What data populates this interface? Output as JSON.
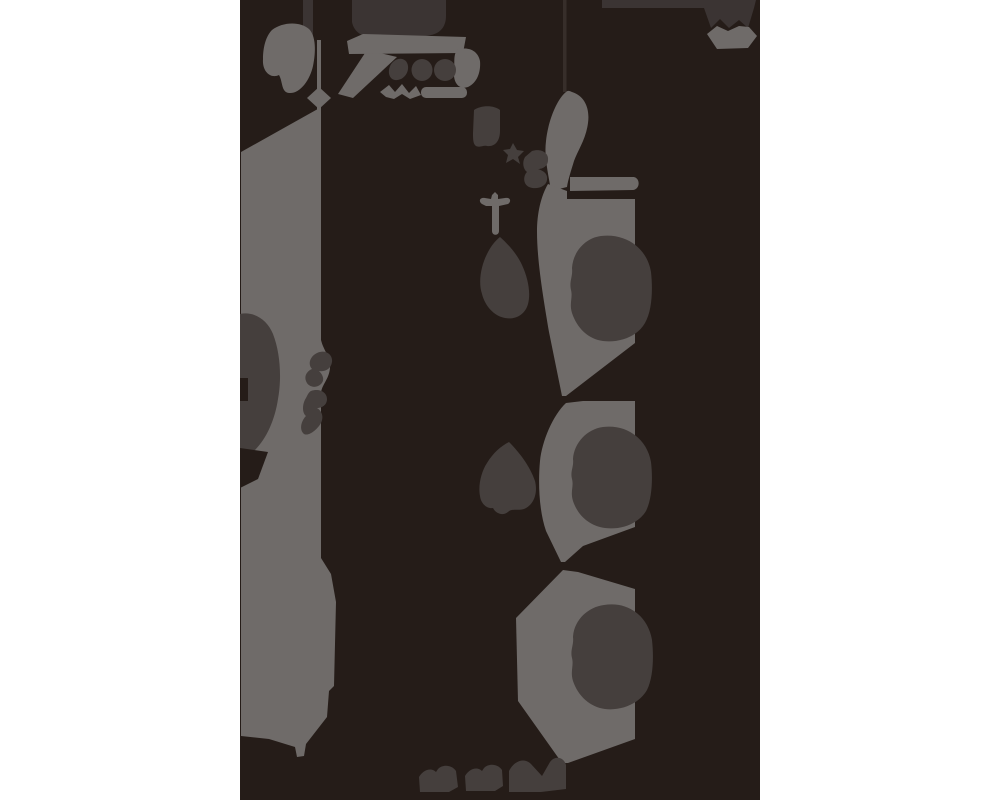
{
  "canvas": {
    "width": 1000,
    "height": 800,
    "background_color": "#ffffff"
  },
  "panel": {
    "x": 240,
    "y": 0,
    "width": 520,
    "height": 800,
    "tone": "panel_dark"
  },
  "palette": {
    "white": "#ffffff",
    "panel_dark": "#251c18",
    "light_gray": "#6f6b69",
    "mid_gray": "#453f3d",
    "dim_gray": "#3b3433",
    "faint_line": "#372e2a"
  },
  "figure": {
    "description_tones": [
      "panel_dark",
      "light_gray",
      "mid_gray",
      "dim_gray"
    ],
    "regions": [
      {
        "name": "top-left-kidney-blob",
        "tone": "light_gray"
      },
      {
        "name": "thin-vertical-line-with-diamond",
        "tone": "light_gray"
      },
      {
        "name": "checkmark-like-mark",
        "tone": "light_gray"
      },
      {
        "name": "top-light-band",
        "tone": "light_gray"
      },
      {
        "name": "three-round-glyphs",
        "tone": "mid_gray"
      },
      {
        "name": "small-wiggle-marks",
        "tone": "light_gray"
      },
      {
        "name": "right-small-blob",
        "tone": "light_gray"
      },
      {
        "name": "tall-left-column",
        "tone": "light_gray"
      },
      {
        "name": "left-edge-bulge",
        "tone": "mid_gray"
      },
      {
        "name": "column-curls",
        "tone": "mid_gray"
      },
      {
        "name": "square-blob",
        "tone": "mid_gray"
      },
      {
        "name": "four-point-star",
        "tone": "mid_gray"
      },
      {
        "name": "cluster-blob",
        "tone": "mid_gray"
      },
      {
        "name": "swoosh-crescent",
        "tone": "light_gray"
      },
      {
        "name": "horizontal-shelf-bar",
        "tone": "light_gray"
      },
      {
        "name": "dagger-cross",
        "tone": "light_gray"
      },
      {
        "name": "right-column-segment-1",
        "tone": "light_gray"
      },
      {
        "name": "right-column-segment-2",
        "tone": "light_gray"
      },
      {
        "name": "right-column-segment-3",
        "tone": "light_gray"
      },
      {
        "name": "inner-oval-1",
        "tone": "mid_gray"
      },
      {
        "name": "inner-oval-2",
        "tone": "mid_gray"
      },
      {
        "name": "inner-oval-3",
        "tone": "mid_gray"
      },
      {
        "name": "teardrop-1",
        "tone": "mid_gray"
      },
      {
        "name": "teardrop-2",
        "tone": "mid_gray"
      },
      {
        "name": "top-strip-left",
        "tone": "dim_gray"
      },
      {
        "name": "top-block",
        "tone": "dim_gray"
      },
      {
        "name": "top-right-band-m",
        "tone": "dim_gray"
      },
      {
        "name": "top-right-hexagon",
        "tone": "light_gray"
      },
      {
        "name": "faint-vertical-line",
        "tone": "faint_line"
      },
      {
        "name": "bottom-squiggle-1",
        "tone": "mid_gray"
      },
      {
        "name": "bottom-squiggle-2",
        "tone": "mid_gray"
      },
      {
        "name": "bottom-squiggle-3",
        "tone": "mid_gray"
      }
    ]
  }
}
